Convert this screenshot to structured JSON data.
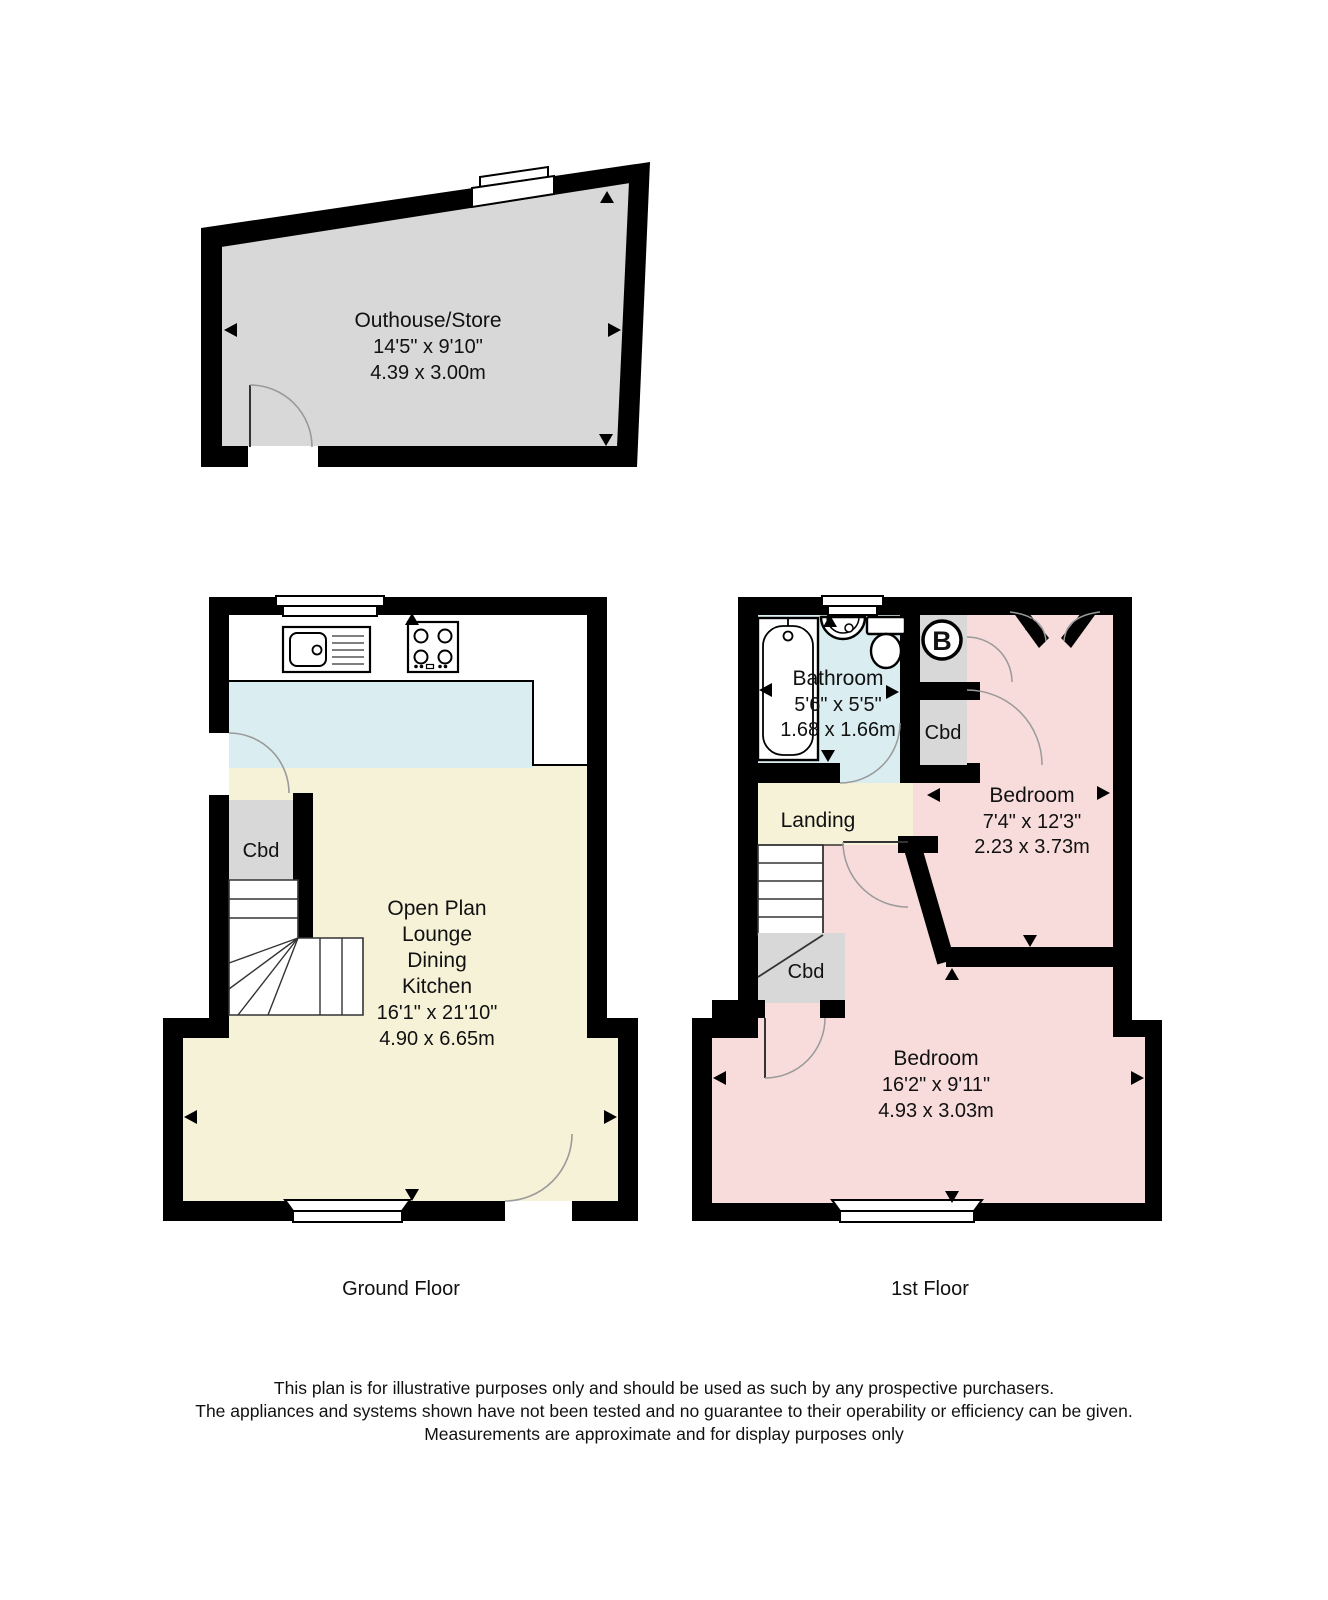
{
  "outhouse": {
    "name": "Outhouse/Store",
    "dims_ft": "14'5\" x 9'10\"",
    "dims_m": "4.39 x 3.00m"
  },
  "ground_floor": {
    "caption": "Ground Floor",
    "open_plan": {
      "line1": "Open Plan",
      "line2": "Lounge",
      "line3": "Dining",
      "line4": "Kitchen",
      "dims_ft": "16'1\" x 21'10\"",
      "dims_m": "4.90 x 6.65m"
    },
    "cupboard": "Cbd"
  },
  "first_floor": {
    "caption": "1st Floor",
    "bathroom": {
      "name": "Bathroom",
      "dims_ft": "5'6\" x 5'5\"",
      "dims_m": "1.68 x 1.66m"
    },
    "landing": "Landing",
    "boiler": "B",
    "cupboard_top": "Cbd",
    "cupboard_stairs": "Cbd",
    "bedroom_small": {
      "name": "Bedroom",
      "dims_ft": "7'4\" x 12'3\"",
      "dims_m": "2.23 x 3.73m"
    },
    "bedroom_large": {
      "name": "Bedroom",
      "dims_ft": "16'2\" x 9'11\"",
      "dims_m": "4.93 x 3.03m"
    }
  },
  "disclaimer": [
    "This plan is for illustrative purposes only and should be used as such by any prospective purchasers.",
    "The appliances and systems shown have not been tested and no guarantee to their operability or efficiency can be given.",
    "Measurements are approximate and for display purposes only"
  ],
  "colors": {
    "wall": "#000000",
    "lounge_floor": "#f5f2d8",
    "wet_floor": "#daedf0",
    "bedroom_floor": "#f7dcdb",
    "cupboard_fill": "#d8d8d8",
    "outhouse_floor": "#d8d8d8",
    "door_arc": "#9a9a9a"
  }
}
